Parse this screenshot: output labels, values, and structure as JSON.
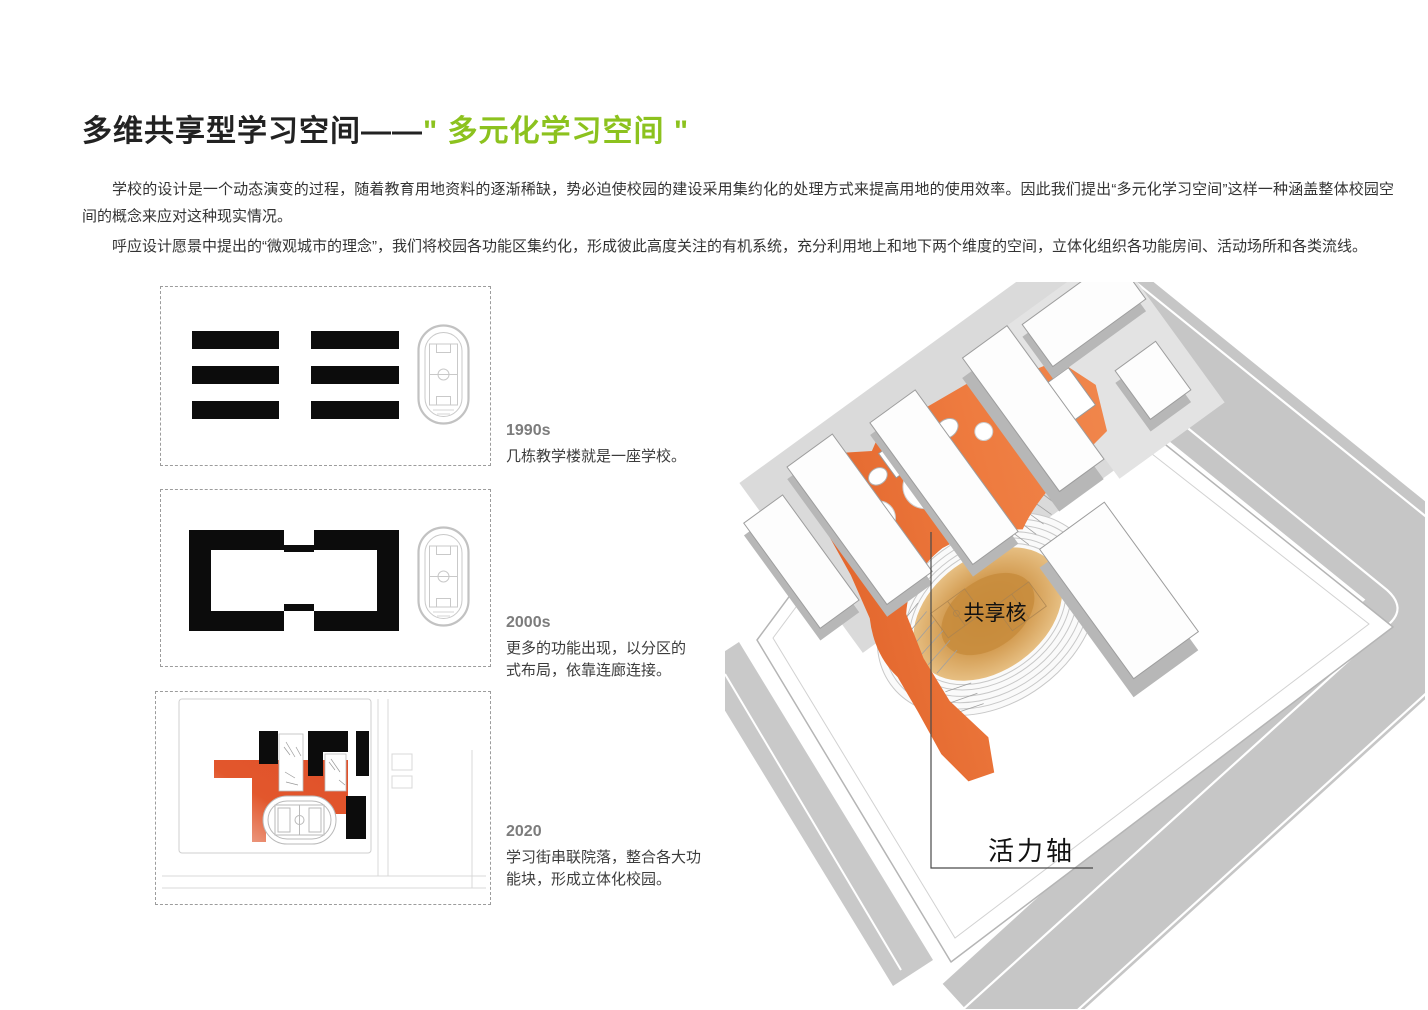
{
  "header": {
    "title_main": "多维共享型学习空间——",
    "title_quoted": "\" 多元化学习空间 \""
  },
  "intro": {
    "p1": "学校的设计是一个动态演变的过程，随着教育用地资料的逐渐稀缺，势必迫使校园的建设采用集约化的处理方式来提高用地的使用效率。因此我们提出“多元化学习空间”这样一种涵盖整体校园空间的概念来应对这种现实情况。",
    "p2": "呼应设计愿景中提出的“微观城市的理念”，我们将校园各功能区集约化，形成彼此高度关注的有机系统，充分利用地上和地下两个维度的空间，立体化组织各功能房间、活动场所和各类流线。"
  },
  "timeline": [
    {
      "era": "1990s",
      "desc": "几栋教学楼就是一座学校。"
    },
    {
      "era": "2000s",
      "desc": "更多的功能出现，以分区的式布局，依靠连廊连接。"
    },
    {
      "era": "2020",
      "desc": "学习街串联院落，整合各大功能块，形成立体化校园。"
    }
  ],
  "axon": {
    "core_label": "共享核",
    "axis_label": "活力轴"
  },
  "colors": {
    "accent_green": "#8cc21e",
    "deck_orange": "#ee7b3f",
    "plan_orange": "#e0572c",
    "track_amber": "#cf9440",
    "building_black": "#0c0c0c",
    "road_gray": "#c9c9c9"
  }
}
